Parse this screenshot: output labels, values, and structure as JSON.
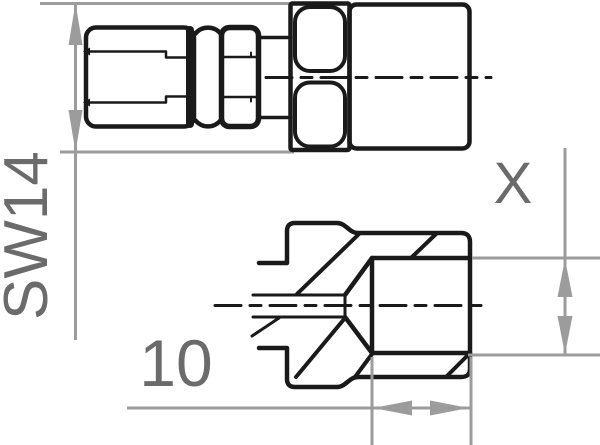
{
  "meta": {
    "type": "technical-drawing",
    "subject": "Hose fitting with female thread shown in side elevation and cross-section"
  },
  "colors": {
    "outline": "#1a1a1a",
    "dimension_line": "#9c9c9c",
    "dimension_text": "#6b6b6b",
    "background": "#ffffff"
  },
  "dimensions": {
    "wrench_size": {
      "label": "SW14"
    },
    "thread_bore": {
      "label": "X"
    },
    "bore_depth": {
      "label": "10"
    }
  }
}
